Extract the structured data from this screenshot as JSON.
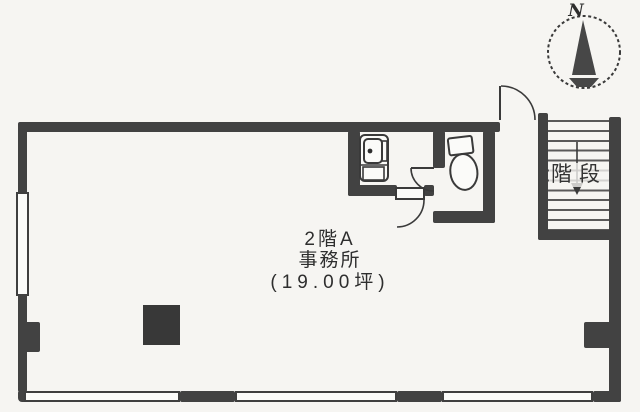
{
  "plan": {
    "type": "real-estate-floor-plan",
    "room_label": {
      "line1": "2階A",
      "line2": "事務所",
      "line3": "(19.00坪)"
    },
    "stairs": {
      "label": "階段",
      "direction_icon": "down-arrow-icon"
    },
    "compass": {
      "label": "N",
      "icon": "compass-north-icon"
    },
    "fixtures": [
      {
        "name": "toilet-icon",
        "room": "WC"
      },
      {
        "name": "sink-unit-icon",
        "room": "washroom"
      }
    ],
    "doors": [
      {
        "name": "entry-door",
        "type": "swing",
        "location": "top-wall"
      },
      {
        "name": "washroom-door",
        "type": "swing",
        "location": "washroom-south"
      },
      {
        "name": "wc-door",
        "type": "swing",
        "location": "wc-partition"
      }
    ],
    "colors": {
      "paper": "#f6f5f2",
      "wall": "#424242",
      "line": "#3a3a3a",
      "pillar_fill": "#383838",
      "text": "#2b2b2b"
    }
  }
}
